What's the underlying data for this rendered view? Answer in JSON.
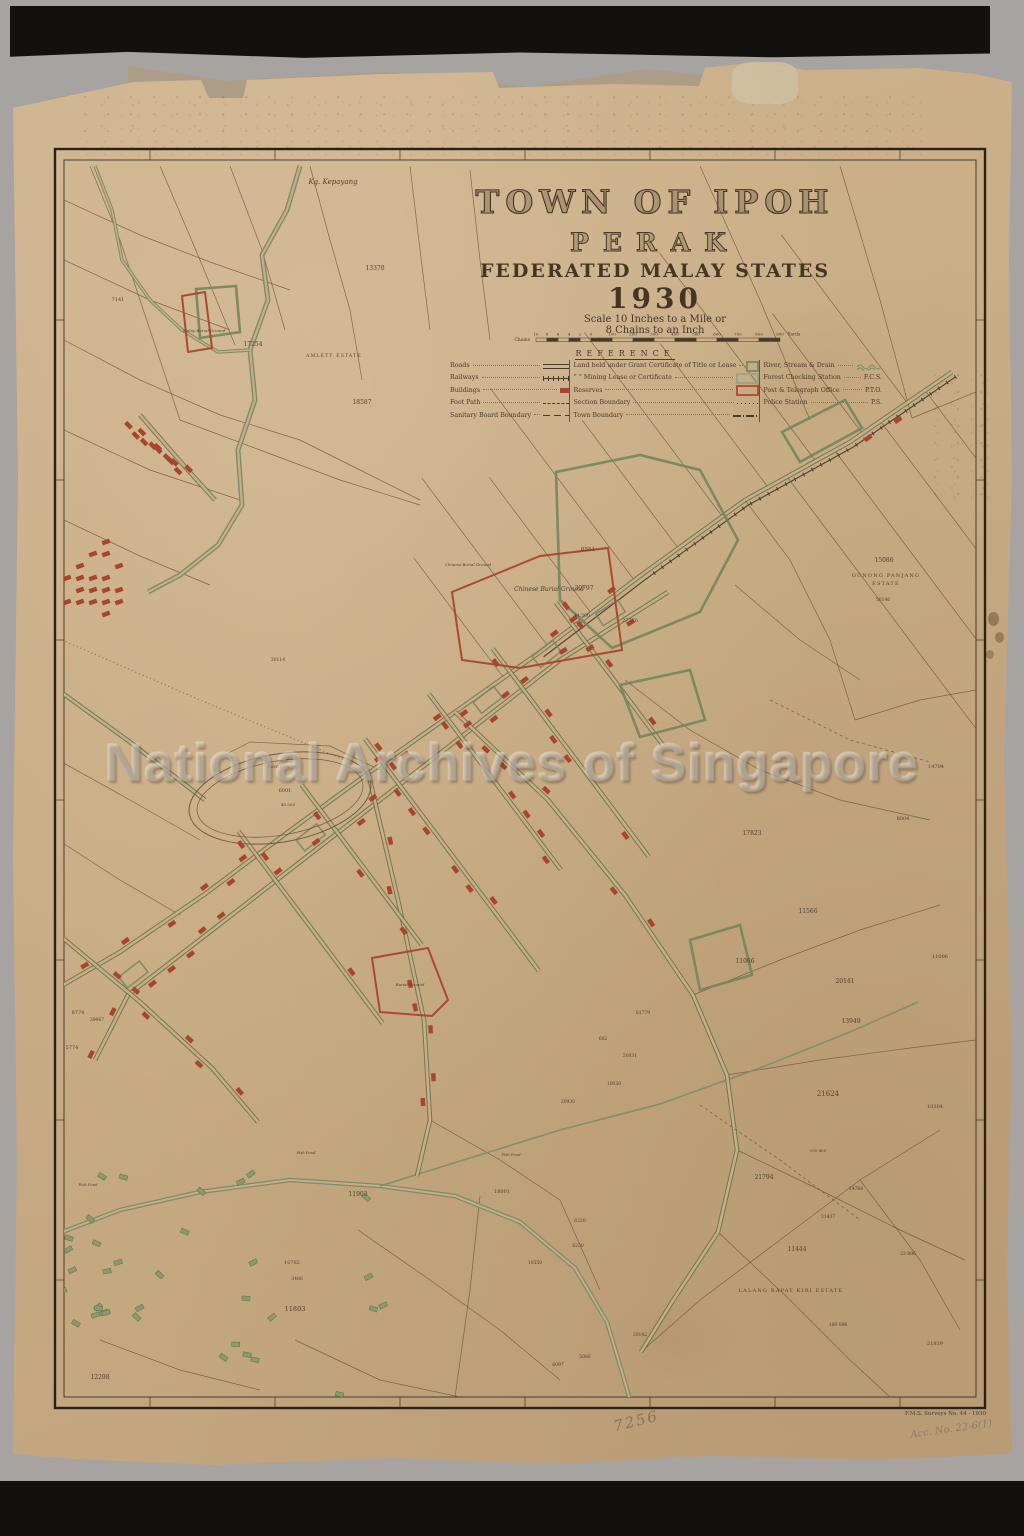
{
  "title_block": {
    "title": "TOWN OF IPOH",
    "subtitle": "PERAK",
    "state_line": "FEDERATED MALAY STATES",
    "year": "1930",
    "scale_line1": "Scale 10 Inches to a Mile or",
    "scale_line2": "8 Chains to an Inch"
  },
  "scale_bar": {
    "left_unit": "Chains",
    "left_ticks": [
      "10",
      "8",
      "6",
      "4",
      "2",
      "0"
    ],
    "yard_ticks": [
      "100",
      "200",
      "300",
      "400",
      "500",
      "600",
      "700",
      "800",
      "900"
    ],
    "right_unit": "Yards"
  },
  "legend": {
    "heading": "REFERENCE",
    "col1": [
      {
        "label": "Roads",
        "symbol": "road"
      },
      {
        "label": "Railways",
        "symbol": "rail"
      },
      {
        "label": "Buildings",
        "symbol": "bldg"
      },
      {
        "label": "Foot Path",
        "symbol": "foot"
      },
      {
        "label": "Sanitary Board Boundary",
        "symbol": "san"
      }
    ],
    "col2": [
      {
        "label": "Land held under Grant Certificate of Title or Lease",
        "swatch": "#7d8f62"
      },
      {
        "label": "”  ”  Mining Lease or Certificate",
        "swatch": "#9aa489"
      },
      {
        "label": "Reserves",
        "swatch": "#b0513a"
      },
      {
        "label": "Section Boundary",
        "symbol": "sec"
      },
      {
        "label": "Town Boundary",
        "symbol": "town"
      }
    ],
    "col3": [
      {
        "label": "River, Stream & Drain",
        "abbr": "",
        "symbol": "wave"
      },
      {
        "label": "Forest Checking Station",
        "abbr": "F.C.S."
      },
      {
        "label": "Post & Telegraph Office",
        "abbr": "P.T.O."
      },
      {
        "label": "Police Station",
        "abbr": "P.S."
      }
    ]
  },
  "watermark": "National Archives of Singapore",
  "imprint": "F.M.S. Surveys No. 44 - 1930",
  "annotations": {
    "pencil_number": "7256",
    "acc_note": "Acc. No. 22-6(1)",
    "edge_code": "B6672560"
  },
  "colors": {
    "paper": "#c9ad87",
    "road_green": "#7e8e60",
    "building_red": "#a8442f",
    "line_brown": "#6a523a",
    "ink": "#4a3a28",
    "neatline": "#2b2217"
  },
  "map_labels": [
    {
      "t": "Kg. Kepayang",
      "x": 333,
      "y": 184,
      "s": 7,
      "k": "place"
    },
    {
      "t": "AMLETT ESTATE",
      "x": 334,
      "y": 357,
      "s": 4.5,
      "k": "estate"
    },
    {
      "t": "Chinese Burial Ground",
      "x": 549,
      "y": 591,
      "s": 6,
      "k": "place"
    },
    {
      "t": "Chinese Burial Ground",
      "x": 468,
      "y": 566,
      "s": 4,
      "k": "place"
    },
    {
      "t": "Malay Burial Ground",
      "x": 204,
      "y": 332,
      "s": 4,
      "k": "place"
    },
    {
      "t": "Burial Ground",
      "x": 410,
      "y": 986,
      "s": 4,
      "k": "place"
    },
    {
      "t": "Race Course",
      "x": 282,
      "y": 768,
      "s": 4.5,
      "k": "place"
    },
    {
      "t": "GUNONG PANJANG",
      "x": 886,
      "y": 577,
      "s": 5,
      "k": "estate"
    },
    {
      "t": "ESTATE",
      "x": 886,
      "y": 585,
      "s": 5,
      "k": "estate"
    },
    {
      "t": "LALANG RAPAT KIRI ESTATE",
      "x": 791,
      "y": 1292,
      "s": 5,
      "k": "estate"
    },
    {
      "t": "Fish Pond",
      "x": 306,
      "y": 1154,
      "s": 3.8,
      "k": "place"
    },
    {
      "t": "Fish Pond",
      "x": 511,
      "y": 1156,
      "s": 3.8,
      "k": "place"
    },
    {
      "t": "Fish Pond",
      "x": 88,
      "y": 1186,
      "s": 3.8,
      "k": "place"
    },
    {
      "t": "15086",
      "x": 884,
      "y": 562,
      "s": 6,
      "k": "lot"
    },
    {
      "t": "56146",
      "x": 883,
      "y": 601,
      "s": 4.5,
      "k": "lot"
    },
    {
      "t": "11444",
      "x": 797,
      "y": 1251,
      "s": 6,
      "k": "lot"
    },
    {
      "t": "13370",
      "x": 375,
      "y": 270,
      "s": 6,
      "k": "lot"
    },
    {
      "t": "17254",
      "x": 253,
      "y": 346,
      "s": 6,
      "k": "lot"
    },
    {
      "t": "18587",
      "x": 362,
      "y": 404,
      "s": 6,
      "k": "lot"
    },
    {
      "t": "7141",
      "x": 118,
      "y": 301,
      "s": 5,
      "k": "lot"
    },
    {
      "t": "6551",
      "x": 588,
      "y": 551,
      "s": 5.5,
      "k": "lot"
    },
    {
      "t": "30797",
      "x": 584,
      "y": 590,
      "s": 6,
      "k": "lot"
    },
    {
      "t": "44.500",
      "x": 582,
      "y": 617,
      "s": 4.5,
      "k": "lot"
    },
    {
      "t": "27726",
      "x": 630,
      "y": 622,
      "s": 5,
      "k": "lot"
    },
    {
      "t": "20114",
      "x": 278,
      "y": 661,
      "s": 4.5,
      "k": "lot"
    },
    {
      "t": "6001",
      "x": 285,
      "y": 792,
      "s": 5,
      "k": "lot"
    },
    {
      "t": "40.500",
      "x": 288,
      "y": 806,
      "s": 4,
      "k": "lot"
    },
    {
      "t": "17823",
      "x": 752,
      "y": 835,
      "s": 6,
      "k": "lot"
    },
    {
      "t": "8004",
      "x": 903,
      "y": 820,
      "s": 5,
      "k": "lot"
    },
    {
      "t": "14704",
      "x": 936,
      "y": 768,
      "s": 5,
      "k": "lot"
    },
    {
      "t": "11566",
      "x": 808,
      "y": 913,
      "s": 6,
      "k": "lot"
    },
    {
      "t": "11066",
      "x": 745,
      "y": 963,
      "s": 6,
      "k": "lot"
    },
    {
      "t": "11006",
      "x": 940,
      "y": 958,
      "s": 5,
      "k": "lot"
    },
    {
      "t": "20141",
      "x": 845,
      "y": 983,
      "s": 6,
      "k": "lot"
    },
    {
      "t": "13949",
      "x": 851,
      "y": 1023,
      "s": 6,
      "k": "lot"
    },
    {
      "t": "21624",
      "x": 828,
      "y": 1096,
      "s": 7,
      "k": "lot"
    },
    {
      "t": "100 400",
      "x": 818,
      "y": 1152,
      "s": 4,
      "k": "lot"
    },
    {
      "t": "21794",
      "x": 764,
      "y": 1179,
      "s": 6,
      "k": "lot"
    },
    {
      "t": "14784",
      "x": 856,
      "y": 1190,
      "s": 4.5,
      "k": "lot"
    },
    {
      "t": "31437",
      "x": 828,
      "y": 1218,
      "s": 4.5,
      "k": "lot"
    },
    {
      "t": "23 806",
      "x": 908,
      "y": 1255,
      "s": 4.5,
      "k": "lot"
    },
    {
      "t": "169 096",
      "x": 838,
      "y": 1326,
      "s": 4.5,
      "k": "lot"
    },
    {
      "t": "10304",
      "x": 935,
      "y": 1108,
      "s": 5,
      "k": "lot"
    },
    {
      "t": "21839",
      "x": 935,
      "y": 1345,
      "s": 5,
      "k": "lot"
    },
    {
      "t": "3446",
      "x": 48,
      "y": 1221,
      "s": 5.5,
      "k": "lot"
    },
    {
      "t": "11803",
      "x": 295,
      "y": 1311,
      "s": 6.5,
      "k": "lot"
    },
    {
      "t": "11903",
      "x": 358,
      "y": 1196,
      "s": 6,
      "k": "lot"
    },
    {
      "t": "12298",
      "x": 100,
      "y": 1379,
      "s": 6,
      "k": "lot"
    },
    {
      "t": "10782",
      "x": 292,
      "y": 1264,
      "s": 5,
      "k": "lot"
    },
    {
      "t": "3486",
      "x": 297,
      "y": 1280,
      "s": 4.5,
      "k": "lot"
    },
    {
      "t": "20142",
      "x": 640,
      "y": 1336,
      "s": 4.5,
      "k": "lot"
    },
    {
      "t": "5086",
      "x": 585,
      "y": 1358,
      "s": 4.5,
      "k": "lot"
    },
    {
      "t": "6097",
      "x": 558,
      "y": 1366,
      "s": 4.5,
      "k": "lot"
    },
    {
      "t": "8774",
      "x": 78,
      "y": 1014,
      "s": 5,
      "k": "lot"
    },
    {
      "t": "30067",
      "x": 97,
      "y": 1021,
      "s": 4.5,
      "k": "lot"
    },
    {
      "t": "5774",
      "x": 72,
      "y": 1049,
      "s": 5,
      "k": "lot"
    },
    {
      "t": "8771",
      "x": 50,
      "y": 1082,
      "s": 5,
      "k": "lot"
    },
    {
      "t": "602",
      "x": 603,
      "y": 1040,
      "s": 4.5,
      "k": "lot"
    },
    {
      "t": "50031",
      "x": 630,
      "y": 1057,
      "s": 4.5,
      "k": "lot"
    },
    {
      "t": "10030",
      "x": 614,
      "y": 1085,
      "s": 4.5,
      "k": "lot"
    },
    {
      "t": "20930",
      "x": 568,
      "y": 1103,
      "s": 4.5,
      "k": "lot"
    },
    {
      "t": "81779",
      "x": 643,
      "y": 1014,
      "s": 4.5,
      "k": "lot"
    },
    {
      "t": "6220",
      "x": 580,
      "y": 1222,
      "s": 4.5,
      "k": "lot"
    },
    {
      "t": "8220",
      "x": 578,
      "y": 1247,
      "s": 4.5,
      "k": "lot"
    },
    {
      "t": "10550",
      "x": 535,
      "y": 1264,
      "s": 4.5,
      "k": "lot"
    },
    {
      "t": "18001",
      "x": 502,
      "y": 1193,
      "s": 5,
      "k": "lot"
    }
  ]
}
